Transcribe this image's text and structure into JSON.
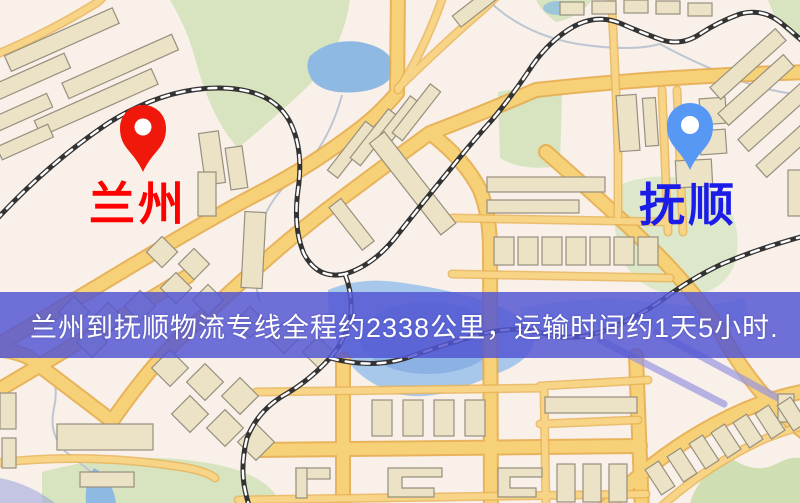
{
  "banner": {
    "text": "兰州到抚顺物流专线全程约2338公里，运输时间约1天5小时.",
    "bg_color": "#5456d3",
    "text_color": "#ffffff"
  },
  "route": {
    "origin": "兰州",
    "destination": "抚顺",
    "distance_text": "约2338公里",
    "duration_text": "约1天5小时"
  },
  "markers": {
    "origin": {
      "label": "兰州",
      "pin_color": "#ea190c",
      "label_color": "#fb0000"
    },
    "destination": {
      "label": "抚顺",
      "pin_color": "#5a98f2",
      "label_color": "#1c1ce2"
    }
  },
  "map_palette": {
    "background": "#f8f0e9",
    "road_fill": "#f6d17b",
    "road_casing": "#e4ac4f",
    "railway": "#333333",
    "water": "#a9c8ea",
    "park": "#d7e4c0",
    "building": "#ece2c6"
  }
}
